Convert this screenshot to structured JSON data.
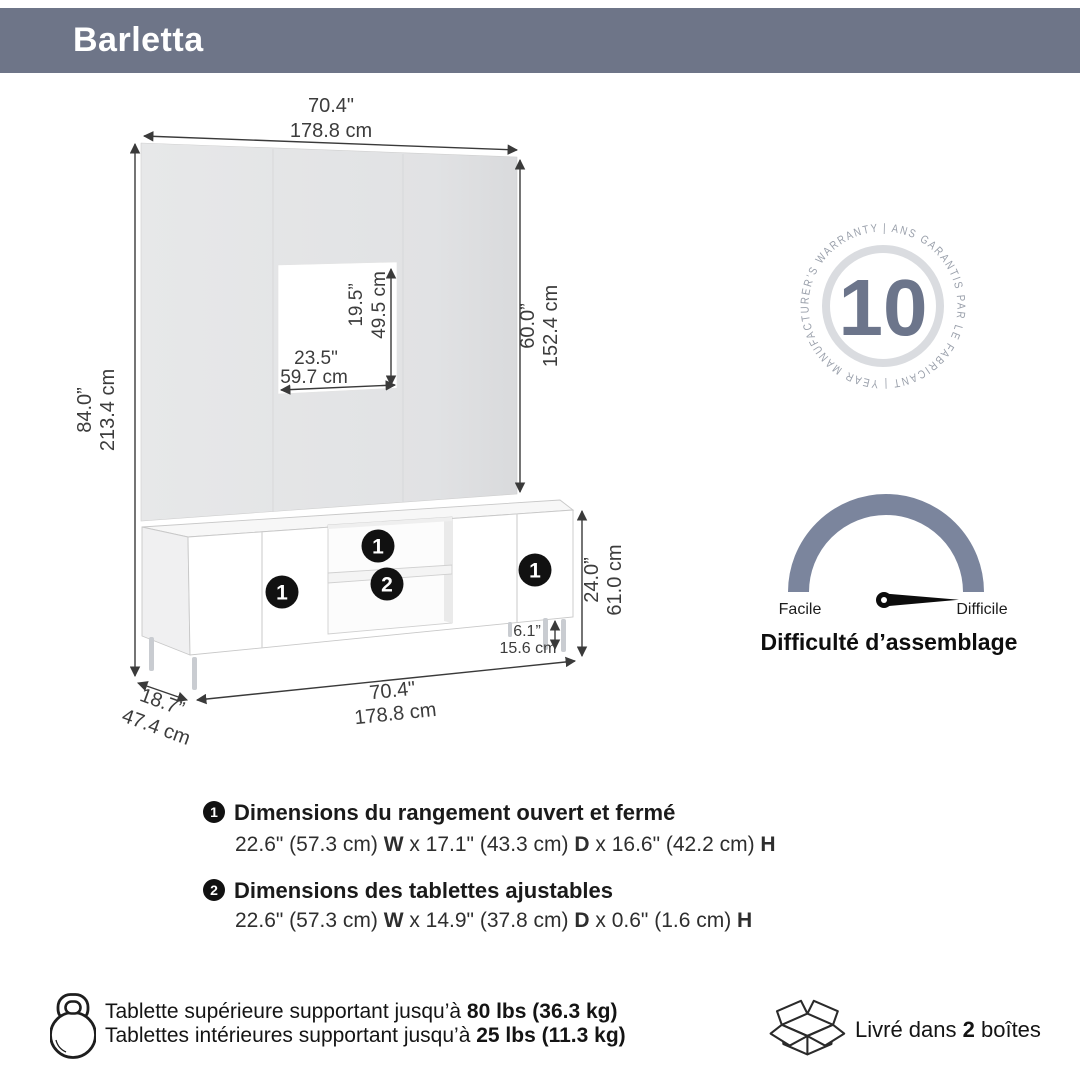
{
  "colors": {
    "header_bg": "#6e7588",
    "accent_slate": "#6c758b",
    "gauge_arc": "#7b859d",
    "panel_gray": "#e3e4e6",
    "marker_black": "#111111",
    "dim_line": "#3a3a3a"
  },
  "header": {
    "title": "Barletta"
  },
  "diagram": {
    "top_width_in": "70.4\"",
    "top_width_cm": "178.8 cm",
    "overall_height_in": "84.0”",
    "overall_height_cm": "213.4 cm",
    "cutout_width_in": "23.5\"",
    "cutout_width_cm": "59.7 cm",
    "cutout_height_in": "19.5”",
    "cutout_height_cm": "49.5 cm",
    "panel_height_in": "60.0”",
    "panel_height_cm": "152.4 cm",
    "stand_height_in": "24.0”",
    "stand_height_cm": "61.0 cm",
    "leg_height_in": "6.1”",
    "leg_height_cm": "15.6 cm",
    "base_width_in": "70.4\"",
    "base_width_cm": "178.8 cm",
    "depth_in": "18.7”",
    "depth_cm": "47.4 cm",
    "marker_storage": "1",
    "marker_shelf": "2"
  },
  "warranty": {
    "years": "10",
    "ring_text": "|  ANS GARANTIS PAR LE FABRICANT  |  YEAR MANUFACTURER’S WARRANTY"
  },
  "difficulty": {
    "easy_label": "Facile",
    "hard_label": "Difficile",
    "title": "Difficulté d’assemblage"
  },
  "legend": {
    "items": [
      {
        "marker": "1",
        "title": "Dimensions du rangement ouvert et fermé",
        "parts": [
          "22.6\" (57.3 cm) ",
          "W",
          " x 17.1\" (43.3 cm) ",
          "D",
          " x 16.6\" (42.2 cm) ",
          "H"
        ]
      },
      {
        "marker": "2",
        "title": "Dimensions des tablettes ajustables",
        "parts": [
          "22.6\" (57.3 cm) ",
          "W",
          " x 14.9\" (37.8 cm) ",
          "D",
          " x 0.6\" (1.6 cm) ",
          "H"
        ]
      }
    ]
  },
  "notes": {
    "capacity_line1": [
      "Tablette supérieure supportant jusqu’à ",
      "80 lbs (36.3 kg)"
    ],
    "capacity_line2": [
      "Tablettes intérieures supportant jusqu’à ",
      "25 lbs (11.3 kg)"
    ],
    "delivery": [
      "Livré dans ",
      "2",
      " boîtes"
    ]
  }
}
